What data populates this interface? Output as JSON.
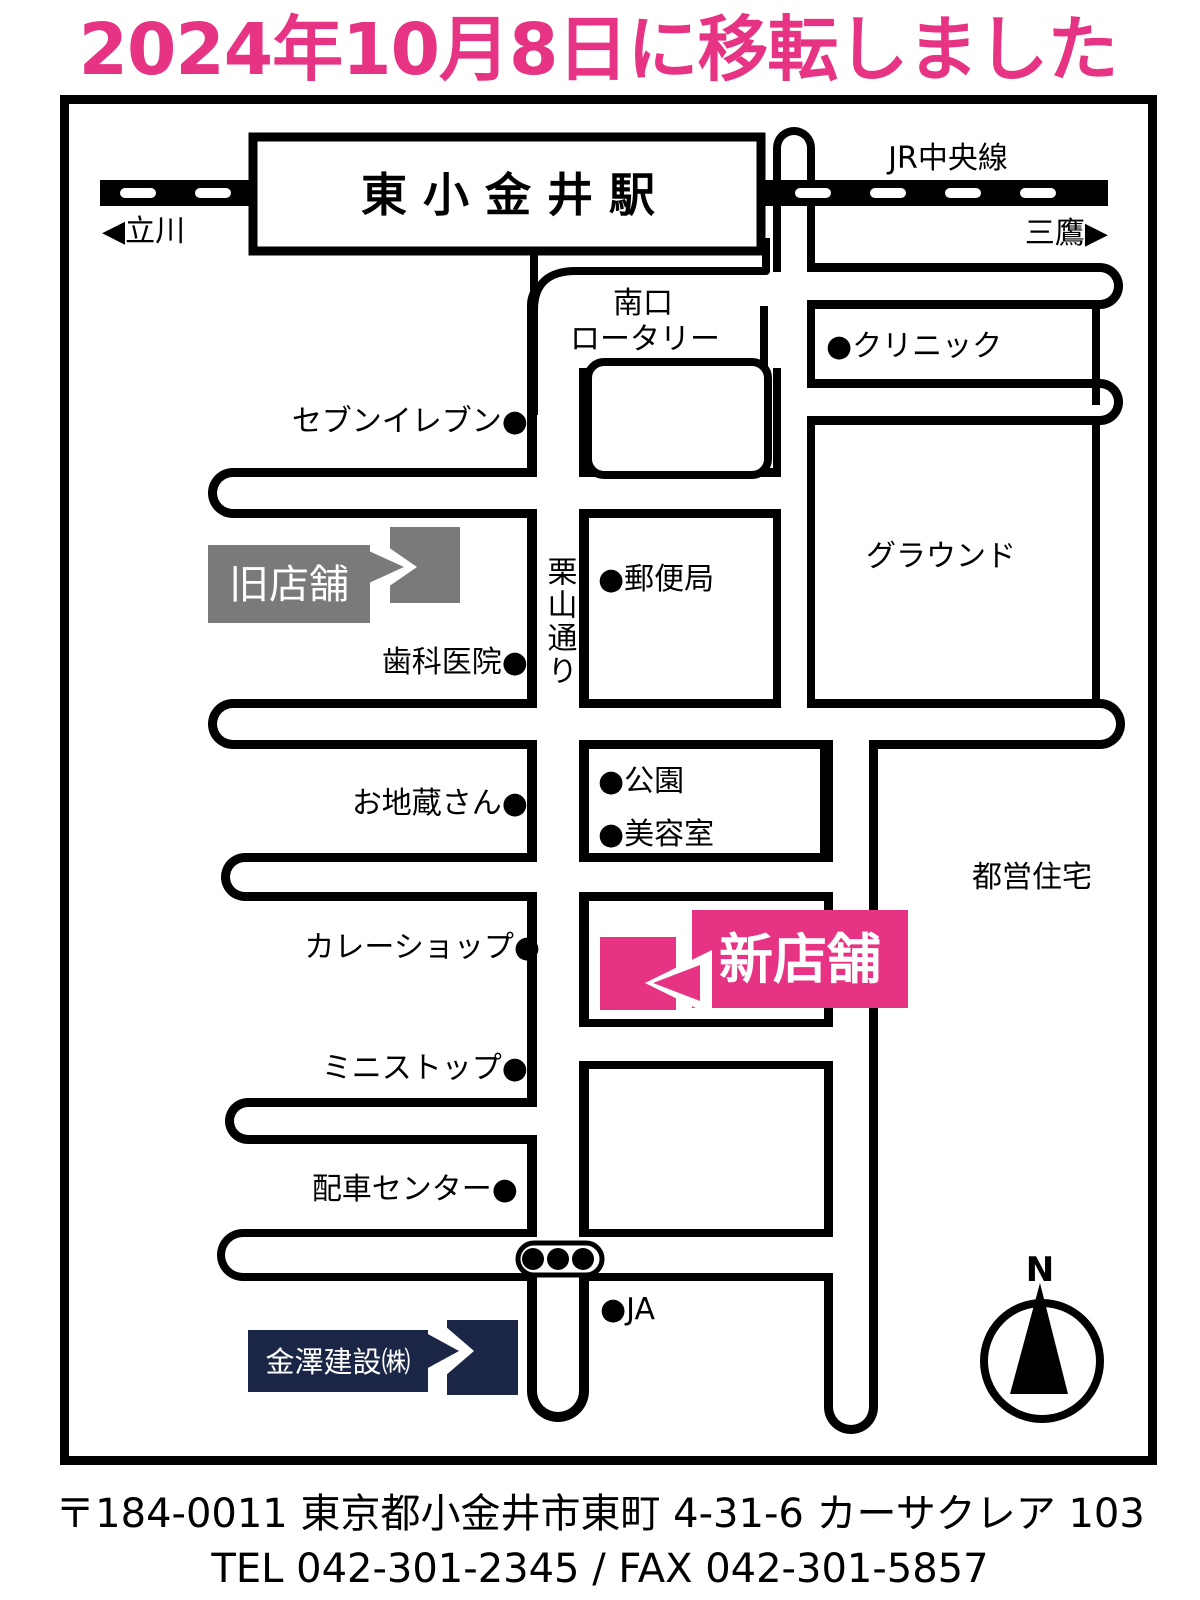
{
  "title": "2024年10月8日に移転しました",
  "station": {
    "name": "東小金井駅"
  },
  "labels": {
    "jr_line": "JR中央線",
    "tachikawa": "◀立川",
    "mitaka": "三鷹▶",
    "minamiguchi": "南口",
    "rotary": "ロータリー",
    "kuriyama_dori": "栗山通り",
    "seven_eleven": "セブンイレブン●",
    "dental": "歯科医院●",
    "ojizosan": "お地蔵さん●",
    "curry_shop": "カレーショップ●",
    "ministop": "ミニストップ●",
    "dispatch_center": "配車センター●",
    "post_office": "●郵便局",
    "park": "●公園",
    "beauty_salon": "●美容室",
    "clinic": "●クリニック",
    "ja": "●JA",
    "ground": "グラウンド",
    "toei_housing": "都営住宅"
  },
  "flags": {
    "old_store": "旧店舗",
    "new_store": "新店舗",
    "company": "金澤建設㈱"
  },
  "compass": {
    "north": "N"
  },
  "footer": {
    "address": "〒184-0011 東京都小金井市東町 4-31-6 カーサクレア 103",
    "tel_fax": "TEL 042-301-2345 / FAX 042-301-5857"
  },
  "colors": {
    "pink": "#e73384",
    "gray": "#7a7a7a",
    "navy": "#1b2546",
    "black": "#000000",
    "white": "#ffffff"
  }
}
